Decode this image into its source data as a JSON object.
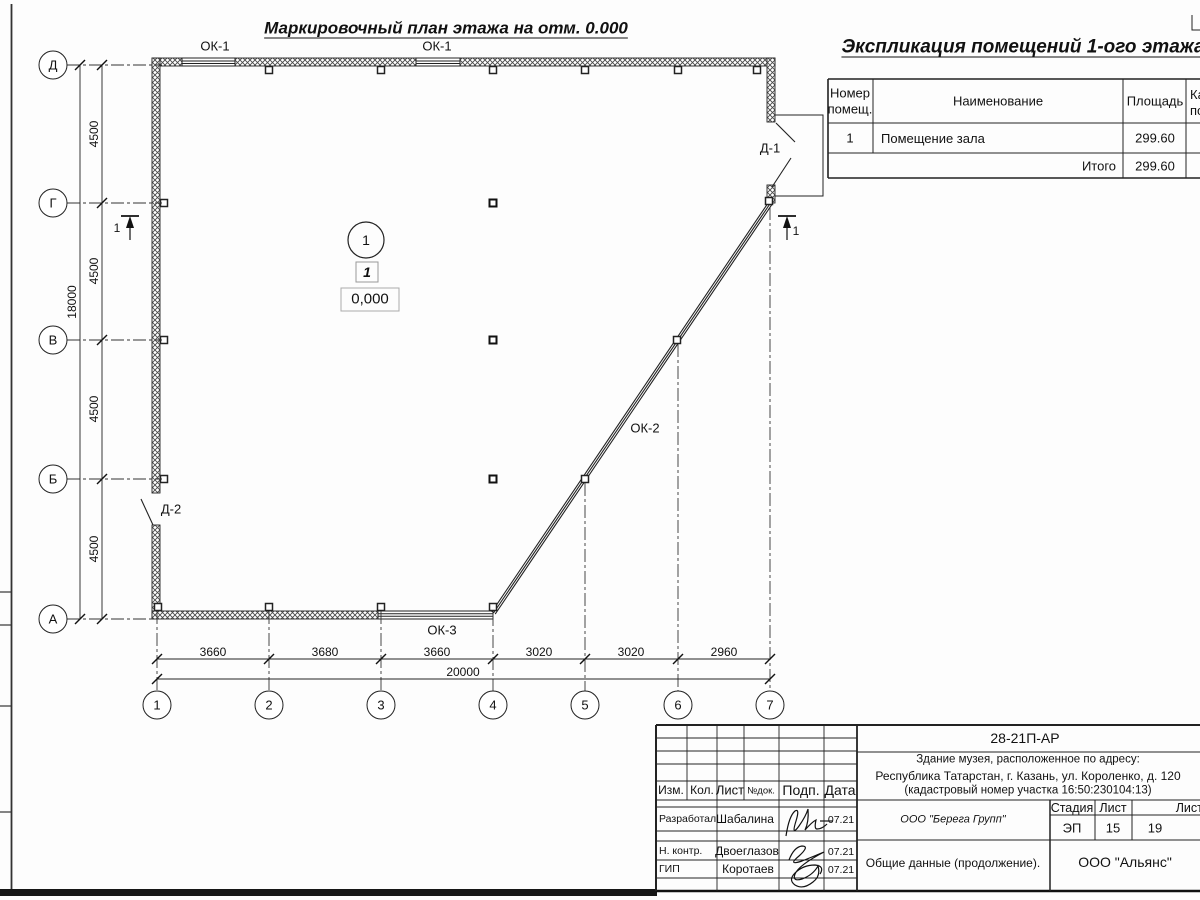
{
  "plan": {
    "title": "Маркировочный план этажа на отм. 0.000",
    "axis_rows": [
      "Д",
      "Г",
      "В",
      "Б",
      "А"
    ],
    "axis_cols": [
      "1",
      "2",
      "3",
      "4",
      "5",
      "6",
      "7"
    ],
    "dims_left": [
      "4500",
      "4500",
      "4500",
      "4500"
    ],
    "dim_left_total": "18000",
    "dims_bottom": [
      "3660",
      "3680",
      "3660",
      "3020",
      "3020",
      "2960"
    ],
    "dim_bottom_total": "20000",
    "window_labels": {
      "ok1a": "ОК-1",
      "ok1b": "ОК-1",
      "ok2": "ОК-2",
      "ok3": "ОК-3"
    },
    "door_labels": {
      "d1": "Д-1",
      "d2": "Д-2"
    },
    "room_number_circle": "1",
    "room_number_box": "1",
    "elevation_mark": "0,000",
    "section_mark_left": "1",
    "section_mark_right": "1"
  },
  "explication": {
    "title": "Экспликация помещений 1-ого этажа",
    "col_num_line1": "Номер",
    "col_num_line2": "помещ.",
    "col_name": "Наименование",
    "col_area": "Площадь",
    "col_cat_line1": "Ка",
    "col_cat_line2": "по",
    "rows": [
      {
        "num": "1",
        "name": "Помещение зала",
        "area": "299.60"
      }
    ],
    "total_label": "Итого",
    "total_value": "299.60"
  },
  "stamp": {
    "doc_number": "28-21П-АР",
    "address1": "Здание музея, расположенное по адресу:",
    "address2": "Республика Татарстан, г. Казань, ул. Короленко, д. 120",
    "address3": "(кадастровый номер участка 16:50:230104:13)",
    "designer_org": "ООО \"Берега Групп\"",
    "stage_label": "Стадия",
    "sheet_label": "Лист",
    "sheets_label": "Листов",
    "stage": "ЭП",
    "sheet": "15",
    "sheets": "19",
    "doc_title": "Общие данные (продолжение).",
    "company": "ООО \"Альянс\"",
    "head_cols": [
      "Изм.",
      "Кол.",
      "Лист",
      "№док.",
      "Подп.",
      "Дата"
    ],
    "sign_rows": [
      {
        "role": "Разработал",
        "name": "Шабалина",
        "date": "07.21"
      },
      {
        "role": "Н. контр.",
        "name": "Двоеглазов",
        "date": "07.21"
      },
      {
        "role": "ГИП",
        "name": "Коротаев",
        "date": "07.21"
      }
    ]
  }
}
